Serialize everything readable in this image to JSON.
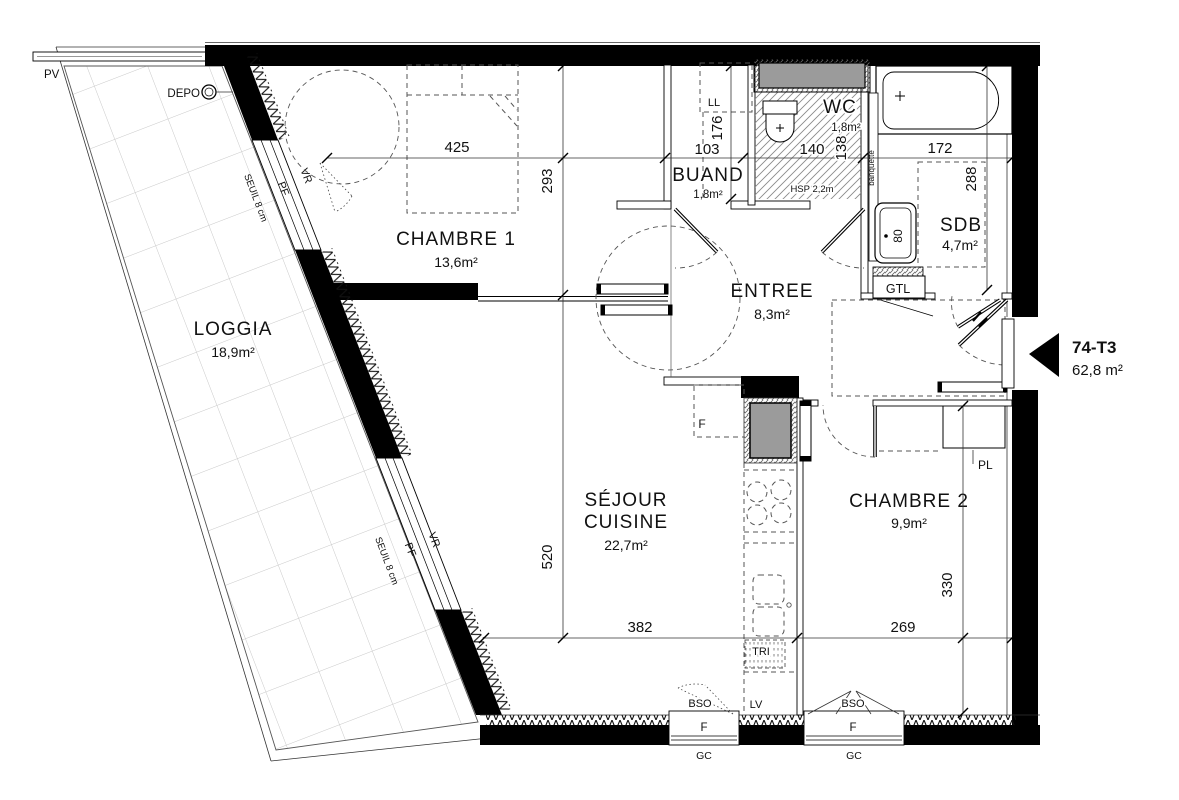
{
  "unit": {
    "code": "74-T3",
    "area": "62,8 m²"
  },
  "rooms": {
    "loggia": {
      "name": "LOGGIA",
      "area": "18,9m²"
    },
    "chambre1": {
      "name": "CHAMBRE 1",
      "area": "13,6m²"
    },
    "sejour": {
      "line1": "SÉJOUR",
      "line2": "CUISINE",
      "area": "22,7m²"
    },
    "entree": {
      "name": "ENTREE",
      "area": "8,3m²"
    },
    "buand": {
      "name": "BUAND",
      "area": "1,8m²"
    },
    "wc": {
      "name": "WC",
      "area": "1,8m²"
    },
    "sdb": {
      "name": "SDB",
      "area": "4,7m²"
    },
    "chambre2": {
      "name": "CHAMBRE 2",
      "area": "9,9m²"
    }
  },
  "dims": {
    "chambre1_w": "425",
    "chambre1_h": "293",
    "buand_w": "103",
    "buand_h": "176",
    "wc_w": "140",
    "wc_h": "138",
    "sdb_w": "172",
    "sdb_h": "288",
    "sejour_h": "520",
    "sejour_w": "382",
    "chambre2_w": "269",
    "chambre2_h": "330",
    "basin_w": "80"
  },
  "labels": {
    "pv": "PV",
    "depo": "DEPO",
    "ll": "LL",
    "hsp": "HSP 2,2m",
    "banquette": "banquette",
    "gtl": "GTL",
    "pl": "PL",
    "fridge": "F",
    "tri": "TRI",
    "lv": "LV",
    "bso": "BSO",
    "window": "F",
    "gc": "GC",
    "seuil": "SEUIL 8 cm",
    "pf": "PF",
    "vr": "VR"
  },
  "colors": {
    "wall": "#000000",
    "fixture_gray": "#9b9b9b",
    "line": "#1a1a1a"
  }
}
